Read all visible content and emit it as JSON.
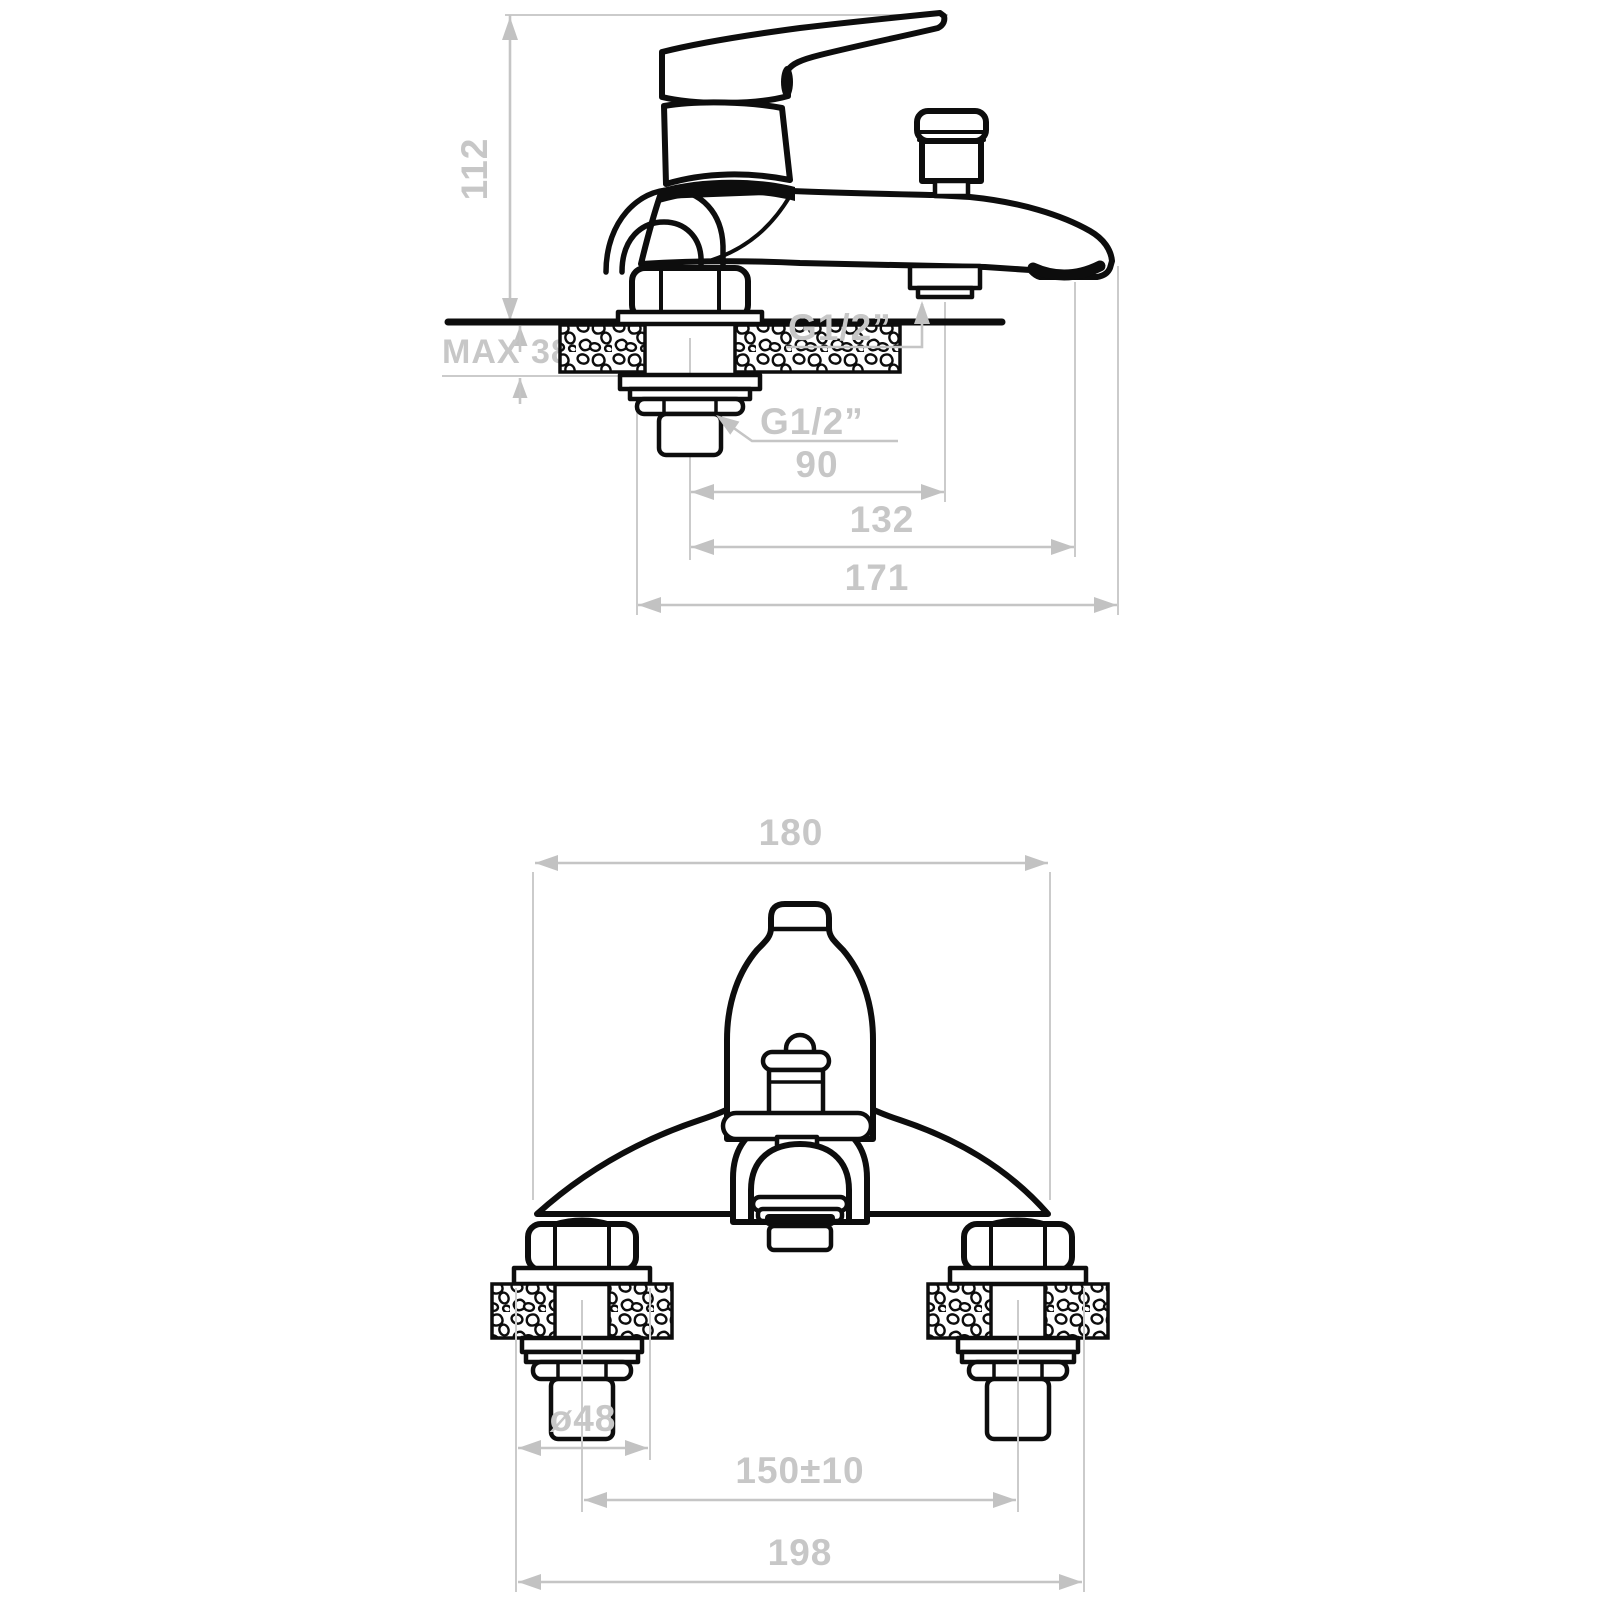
{
  "drawing": {
    "type": "faucet installation technical drawing",
    "colors": {
      "line": "#0d0d0d",
      "dimension": "#c7c7c7",
      "background": "#ffffff"
    },
    "side_view": {
      "height_dim": "112",
      "deck_max_thickness_dim": "MAX 38",
      "shower_outlet_thread": "G1/2”",
      "inlet_tail_thread": "G1/2”",
      "tail_to_shower_outlet_dim": "90",
      "tail_to_aerator_dim": "132",
      "overall_projection_dim": "171"
    },
    "front_view": {
      "body_width_dim": "180",
      "flange_diameter_dim": "ø48",
      "inlet_centres_dim": "150±10",
      "overall_width_dim": "198"
    }
  }
}
